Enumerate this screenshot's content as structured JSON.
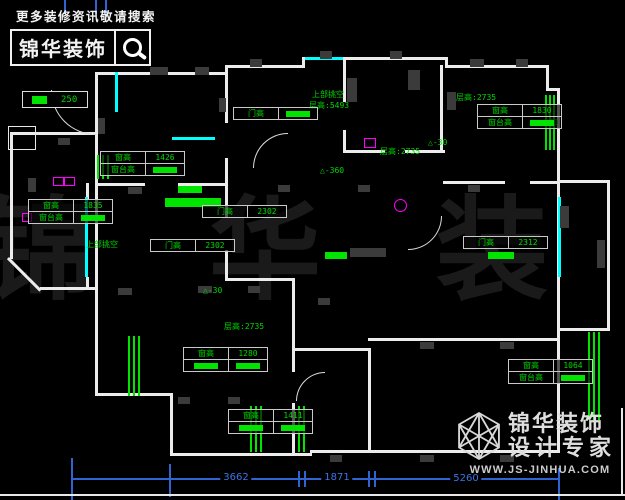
{
  "header": {
    "tagline": "更多装修资讯敬请搜索",
    "brand": "锦华装饰"
  },
  "footer": {
    "brand_line1": "锦华装饰",
    "brand_line2": "设计专家",
    "url": "WWW.JS-JINHUA.COM"
  },
  "watermark": "锦 华 装 饰",
  "legend": {
    "value": "250"
  },
  "colors": {
    "wall": "#ececec",
    "window": "#00ffff",
    "highlight": "#00e400",
    "annotation": "#00d800",
    "dimension": "#2f64d2",
    "fixture": "#ff00ff"
  },
  "plan": {
    "walls": [
      [
        95,
        72,
        133,
        3
      ],
      [
        225,
        65,
        80,
        3
      ],
      [
        302,
        57,
        146,
        3
      ],
      [
        302,
        57,
        3,
        11
      ],
      [
        445,
        57,
        3,
        11
      ],
      [
        445,
        65,
        104,
        3
      ],
      [
        546,
        65,
        3,
        26
      ],
      [
        546,
        88,
        14,
        3
      ],
      [
        557,
        88,
        3,
        242
      ],
      [
        557,
        180,
        53,
        3
      ],
      [
        607,
        180,
        3,
        150
      ],
      [
        557,
        328,
        53,
        3
      ],
      [
        557,
        328,
        3,
        125
      ],
      [
        310,
        450,
        250,
        3
      ],
      [
        170,
        453,
        142,
        3
      ],
      [
        170,
        395,
        3,
        61
      ],
      [
        95,
        393,
        78,
        3
      ],
      [
        95,
        282,
        3,
        114
      ],
      [
        95,
        72,
        3,
        114
      ],
      [
        95,
        186,
        3,
        96
      ],
      [
        225,
        65,
        3,
        58
      ],
      [
        225,
        158,
        3,
        28
      ],
      [
        95,
        183,
        50,
        3
      ],
      [
        178,
        183,
        50,
        3
      ],
      [
        10,
        132,
        88,
        3
      ],
      [
        10,
        132,
        3,
        127
      ],
      [
        40,
        287,
        57,
        3
      ],
      [
        86,
        183,
        3,
        17
      ],
      [
        86,
        277,
        3,
        12
      ],
      [
        343,
        60,
        3,
        42
      ],
      [
        343,
        130,
        3,
        23
      ],
      [
        343,
        150,
        42,
        3
      ],
      [
        405,
        150,
        40,
        3
      ],
      [
        440,
        65,
        3,
        88
      ],
      [
        443,
        181,
        62,
        3
      ],
      [
        530,
        181,
        30,
        3
      ],
      [
        225,
        186,
        3,
        32
      ],
      [
        225,
        250,
        3,
        30
      ],
      [
        225,
        278,
        70,
        3
      ],
      [
        292,
        280,
        3,
        92
      ],
      [
        292,
        403,
        3,
        52
      ],
      [
        292,
        348,
        78,
        3
      ],
      [
        368,
        348,
        3,
        105
      ],
      [
        368,
        338,
        192,
        3
      ]
    ],
    "outlines": [
      [
        8,
        126,
        26,
        22
      ]
    ],
    "diagonals": [
      {
        "x": 9,
        "y": 257,
        "len": 46,
        "deg": 45
      }
    ],
    "windows": [
      [
        115,
        72,
        3,
        40
      ],
      [
        172,
        137,
        43,
        3
      ],
      [
        85,
        197,
        3,
        80
      ],
      [
        558,
        197,
        3,
        80
      ],
      [
        305,
        57,
        38,
        3
      ]
    ],
    "green_bars": [
      [
        545,
        95,
        2,
        55
      ],
      [
        549,
        95,
        2,
        55
      ],
      [
        553,
        95,
        2,
        55
      ],
      [
        128,
        336,
        2,
        60
      ],
      [
        133,
        336,
        2,
        60
      ],
      [
        138,
        336,
        2,
        60
      ],
      [
        250,
        406,
        2,
        46
      ],
      [
        255,
        406,
        2,
        46
      ],
      [
        260,
        406,
        2,
        46
      ],
      [
        298,
        406,
        2,
        46
      ],
      [
        303,
        406,
        2,
        46
      ],
      [
        588,
        332,
        2,
        88
      ],
      [
        593,
        332,
        2,
        88
      ],
      [
        598,
        332,
        2,
        88
      ],
      [
        97,
        155,
        2,
        24
      ],
      [
        102,
        155,
        2,
        24
      ],
      [
        107,
        155,
        2,
        24
      ]
    ],
    "green_boxes": [
      [
        178,
        186,
        24,
        7
      ],
      [
        165,
        198,
        56,
        9
      ],
      [
        325,
        252,
        22,
        7
      ],
      [
        488,
        252,
        26,
        7
      ]
    ],
    "magenta_rects": [
      [
        364,
        138,
        10,
        8
      ],
      [
        53,
        177,
        9,
        7
      ],
      [
        64,
        177,
        9,
        7
      ],
      [
        22,
        213,
        8,
        7
      ]
    ],
    "magenta_circles": [
      [
        394,
        199,
        11,
        11
      ]
    ],
    "gray_blocks": [
      [
        150,
        67,
        18,
        8
      ],
      [
        195,
        67,
        14,
        8
      ],
      [
        250,
        59,
        12,
        8
      ],
      [
        320,
        51,
        12,
        8
      ],
      [
        390,
        51,
        12,
        8
      ],
      [
        470,
        59,
        14,
        8
      ],
      [
        516,
        59,
        12,
        8
      ],
      [
        347,
        78,
        10,
        24
      ],
      [
        408,
        70,
        12,
        20
      ],
      [
        447,
        92,
        9,
        18
      ],
      [
        98,
        118,
        7,
        16
      ],
      [
        219,
        98,
        7,
        14
      ],
      [
        128,
        187,
        14,
        7
      ],
      [
        278,
        185,
        12,
        7
      ],
      [
        358,
        185,
        12,
        7
      ],
      [
        468,
        185,
        12,
        7
      ],
      [
        560,
        206,
        9,
        22
      ],
      [
        597,
        240,
        8,
        28
      ],
      [
        118,
        288,
        14,
        7
      ],
      [
        198,
        286,
        14,
        7
      ],
      [
        248,
        286,
        12,
        7
      ],
      [
        318,
        298,
        12,
        7
      ],
      [
        420,
        342,
        14,
        7
      ],
      [
        500,
        342,
        14,
        7
      ],
      [
        178,
        397,
        12,
        7
      ],
      [
        228,
        397,
        12,
        7
      ],
      [
        330,
        455,
        12,
        7
      ],
      [
        420,
        455,
        14,
        7
      ],
      [
        500,
        455,
        14,
        7
      ],
      [
        58,
        138,
        12,
        7
      ],
      [
        28,
        178,
        8,
        14
      ],
      [
        350,
        248,
        36,
        9
      ]
    ],
    "arcs": [
      {
        "x": 51,
        "y": 90,
        "r": 44,
        "c": "bl"
      },
      {
        "x": 253,
        "y": 133,
        "r": 34,
        "c": "tl"
      },
      {
        "x": 408,
        "y": 216,
        "r": 33,
        "c": "br"
      },
      {
        "x": 296,
        "y": 372,
        "r": 28,
        "c": "tl"
      }
    ],
    "labels": [
      {
        "t": "上部挑空",
        "x": 312,
        "y": 90
      },
      {
        "t": "层高:5493",
        "x": 309,
        "y": 101
      },
      {
        "t": "层高:2735",
        "x": 380,
        "y": 147
      },
      {
        "t": "层高:2735",
        "x": 456,
        "y": 93
      },
      {
        "t": "层高:2735",
        "x": 224,
        "y": 322
      },
      {
        "t": "上部挑空",
        "x": 86,
        "y": 240
      },
      {
        "t": "△-360",
        "x": 320,
        "y": 166
      },
      {
        "t": "△-30",
        "x": 428,
        "y": 138
      },
      {
        "t": "△-360",
        "x": 534,
        "y": 118
      },
      {
        "t": "△-30",
        "x": 203,
        "y": 286
      }
    ],
    "tables": [
      {
        "x": 477,
        "y": 104,
        "rows": [
          [
            {
              "t": "窗高"
            },
            {
              "t": "1830"
            }
          ],
          [
            {
              "t": "窗台高"
            },
            {
              "h": 1
            }
          ]
        ]
      },
      {
        "x": 100,
        "y": 151,
        "rows": [
          [
            {
              "t": "窗高"
            },
            {
              "t": "1426"
            }
          ],
          [
            {
              "t": "窗台高"
            },
            {
              "h": 1
            }
          ]
        ]
      },
      {
        "x": 28,
        "y": 199,
        "rows": [
          [
            {
              "t": "窗高"
            },
            {
              "t": "1835"
            }
          ],
          [
            {
              "t": "窗台高"
            },
            {
              "h": 1
            }
          ]
        ]
      },
      {
        "x": 233,
        "y": 107,
        "rows": [
          [
            {
              "t": "门高"
            },
            {
              "h": 1
            }
          ]
        ]
      },
      {
        "x": 202,
        "y": 205,
        "rows": [
          [
            {
              "t": "门高"
            },
            {
              "t": "2302"
            }
          ]
        ]
      },
      {
        "x": 150,
        "y": 239,
        "rows": [
          [
            {
              "t": "门高"
            },
            {
              "t": "2302"
            }
          ]
        ]
      },
      {
        "x": 463,
        "y": 236,
        "rows": [
          [
            {
              "t": "门高"
            },
            {
              "t": "2312"
            }
          ]
        ]
      },
      {
        "x": 183,
        "y": 347,
        "rows": [
          [
            {
              "t": "窗高"
            },
            {
              "t": "1280"
            }
          ],
          [
            {
              "h": 1
            },
            {
              "h": 1
            }
          ]
        ]
      },
      {
        "x": 228,
        "y": 409,
        "rows": [
          [
            {
              "t": "窗高"
            },
            {
              "t": "1411"
            }
          ],
          [
            {
              "h": 1
            },
            {
              "h": 1
            }
          ]
        ]
      },
      {
        "x": 508,
        "y": 359,
        "rows": [
          [
            {
              "t": "窗高"
            },
            {
              "t": "1064"
            }
          ],
          [
            {
              "t": "窗台高"
            },
            {
              "h": 1
            }
          ]
        ]
      }
    ],
    "dim_lines": [
      [
        72,
        478,
        488,
        2
      ]
    ],
    "dim_ticks": [
      [
        64,
        0,
        2,
        14
      ],
      [
        95,
        0,
        2,
        14
      ],
      [
        105,
        0,
        2,
        14
      ],
      [
        71,
        458,
        2,
        42
      ],
      [
        169,
        464,
        2,
        33
      ],
      [
        298,
        471,
        2,
        16
      ],
      [
        304,
        471,
        2,
        16
      ],
      [
        368,
        471,
        2,
        16
      ],
      [
        374,
        471,
        2,
        16
      ],
      [
        558,
        468,
        2,
        32
      ]
    ],
    "dim_labels": [
      {
        "t": "3662",
        "x": 236,
        "y": 472
      },
      {
        "t": "1871",
        "x": 337,
        "y": 472
      },
      {
        "t": "5260",
        "x": 466,
        "y": 473
      }
    ],
    "page_borders": [
      [
        0,
        494,
        625,
        2
      ],
      [
        621,
        408,
        2,
        88
      ]
    ]
  }
}
